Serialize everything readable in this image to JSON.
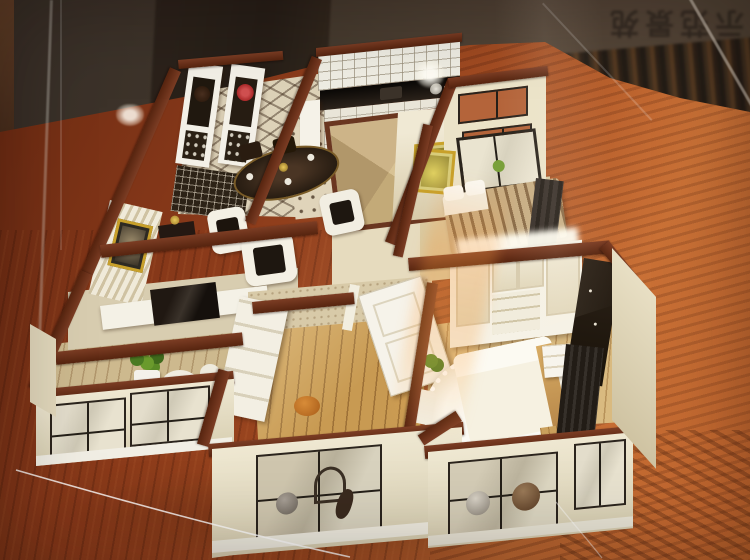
{
  "photo": {
    "subject": "architectural-scale-model-in-glass-case",
    "signage": {
      "text": "示范景苑",
      "orientation": "upside-down-reflection"
    },
    "palette": {
      "background_wall": "#463a2e",
      "table_wood_dark": "#6b2a12",
      "table_wood_light": "#c06a33",
      "model_wall_top": "#5e2b18",
      "model_wall_face": "#e9e1c6",
      "floor_wood": "#c89a52",
      "window_frame": "#2b241d",
      "terracotta_window": "#b4643a",
      "accent_red": "#b03030",
      "gold_frame": "#c8a02a"
    }
  }
}
